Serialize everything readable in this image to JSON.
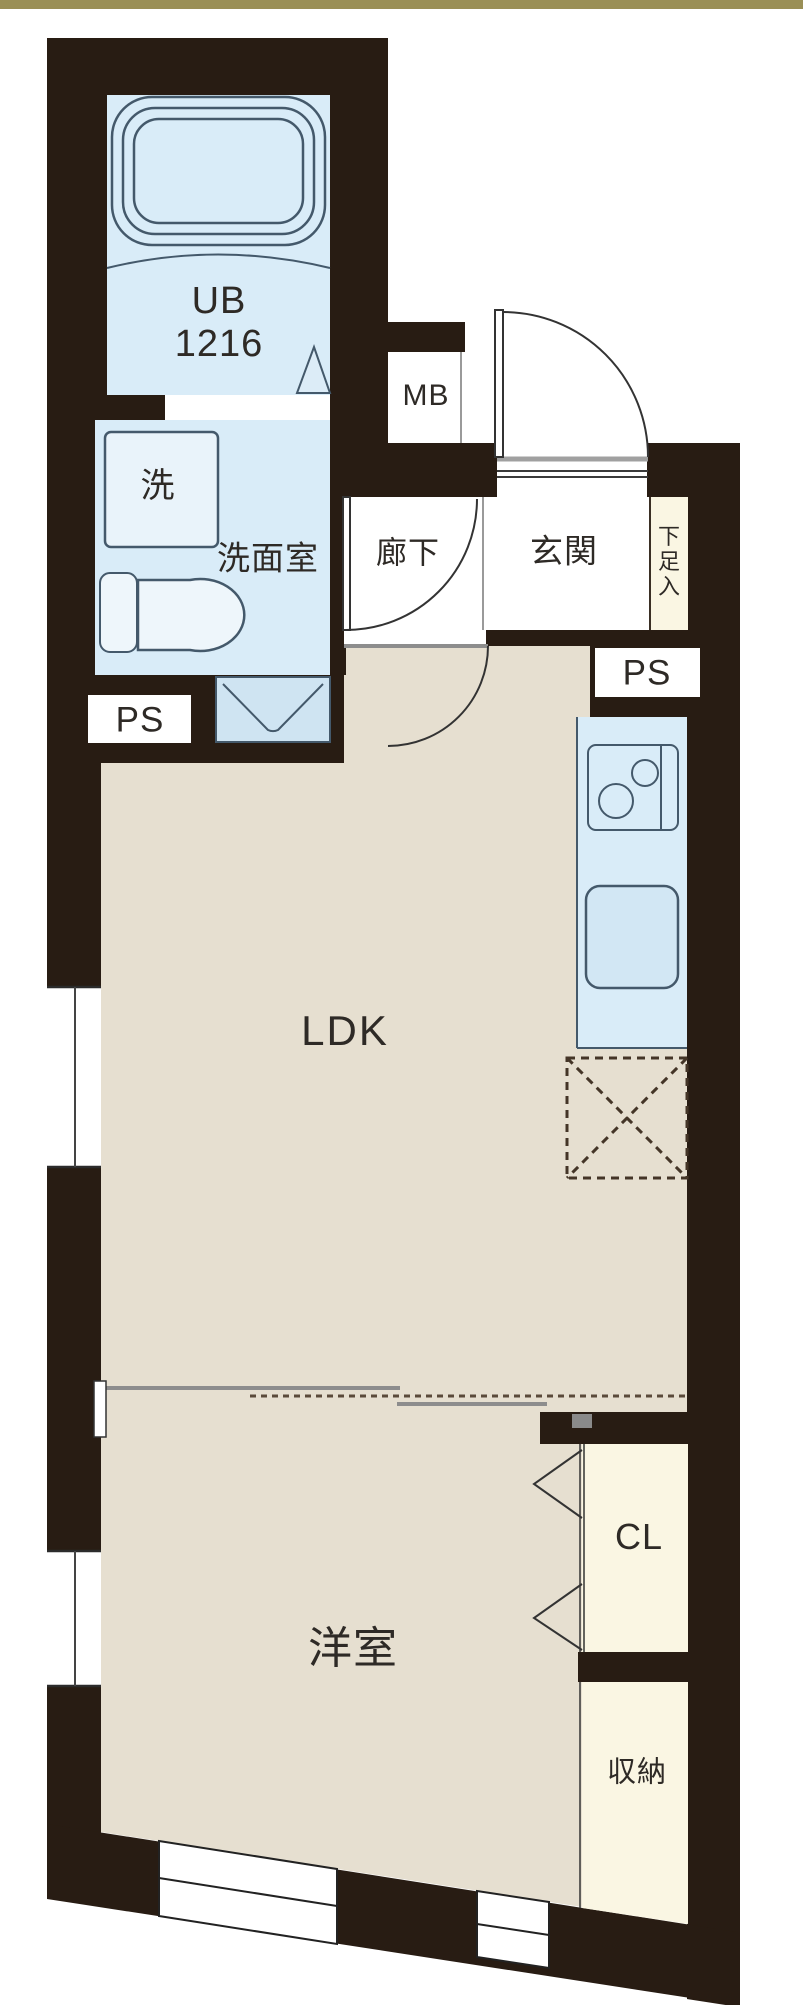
{
  "plan": {
    "type": "floor-plan",
    "labels": {
      "unit_bath_line1": "UB",
      "unit_bath_line2": "1216",
      "meter_box": "MB",
      "washing_machine": "洗",
      "washroom": "洗面室",
      "hallway": "廊下",
      "entrance": "玄関",
      "shoe_cabinet": "下足入",
      "pipe_space_left": "PS",
      "pipe_space_right": "PS",
      "living_dining_kitchen": "LDK",
      "western_room": "洋室",
      "closet": "CL",
      "storage": "収納"
    },
    "colors": {
      "accent_bar": "#9a8f56",
      "wall": "#281c13",
      "water_area_blue": "#d9ecf8",
      "floor_beige": "#e6dfd0",
      "closet_cream": "#faf6e3",
      "fixture_outline": "#44596b",
      "track_gray": "#9a9a9a",
      "text": "#2e2a26"
    }
  }
}
